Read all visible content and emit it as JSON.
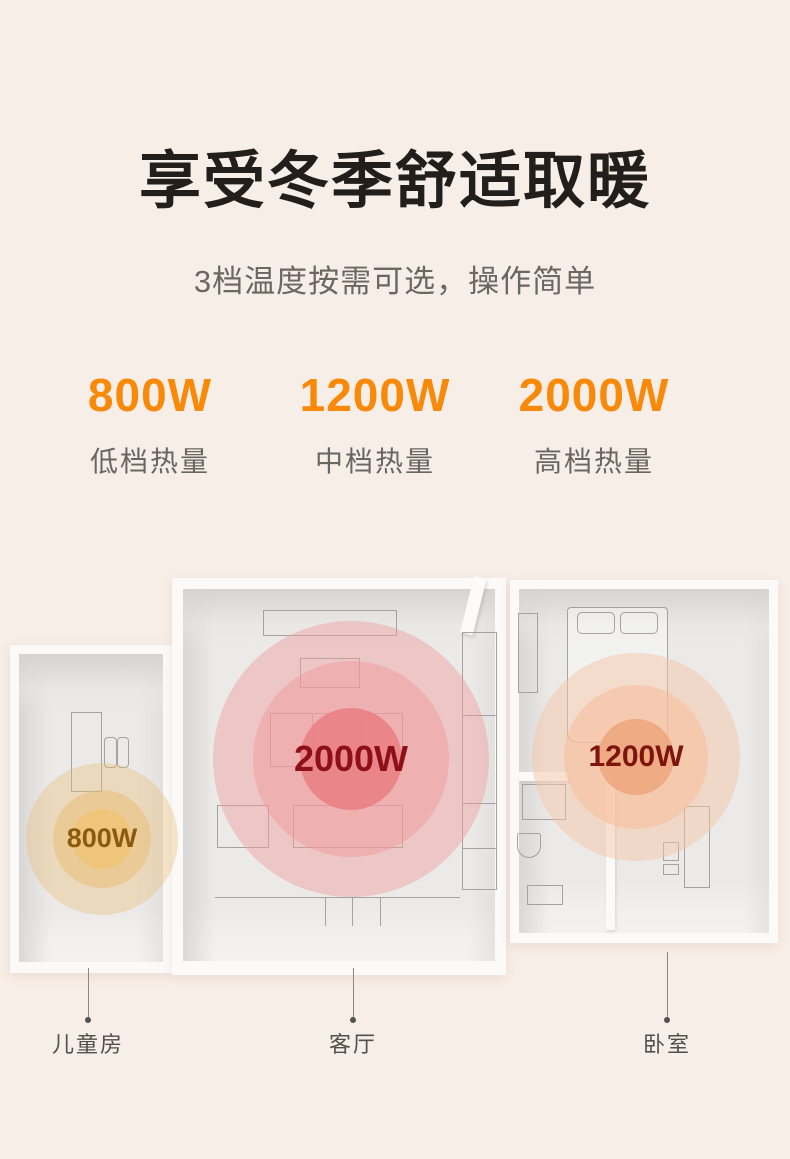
{
  "header": {
    "title": "享受冬季舒适取暖",
    "subtitle": "3档温度按需可选，操作简单"
  },
  "specs": {
    "accent_color": "#F98909",
    "items": [
      {
        "power": "800W",
        "label": "低档热量"
      },
      {
        "power": "1200W",
        "label": "中档热量"
      },
      {
        "power": "2000W",
        "label": "高档热量"
      }
    ]
  },
  "floorplan": {
    "rooms": [
      {
        "name": "儿童房",
        "power": "800W",
        "heat_color": "#EFC478",
        "label_color": "#8A5A12"
      },
      {
        "name": "客厅",
        "power": "2000W",
        "heat_color": "#E97E84",
        "label_color": "#8C1016"
      },
      {
        "name": "卧室",
        "power": "1200W",
        "heat_color": "#EEA87F",
        "label_color": "#7E150D"
      }
    ]
  },
  "colors": {
    "background": "#F7EEE7",
    "title": "#211E1C",
    "subtitle": "#6B6763",
    "room_wall": "#FBFAF9",
    "room_floor": "#EBEAE8",
    "furniture_line": "#A6A29D",
    "pointer": "#8B8884"
  }
}
